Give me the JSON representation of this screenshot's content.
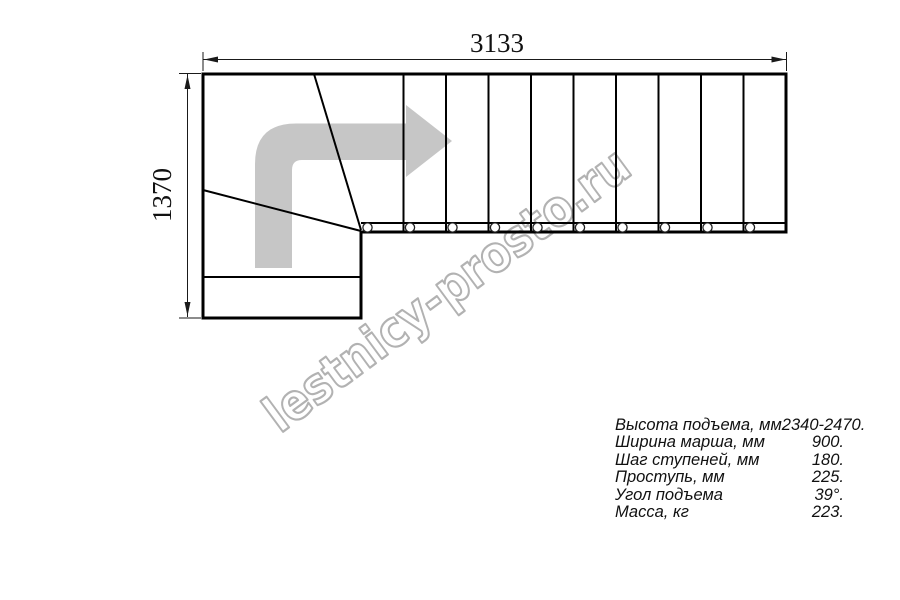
{
  "watermark": {
    "text": "lestnicy-prosto.ru",
    "color": "#b2b2b2"
  },
  "drawing": {
    "width_label": "3133",
    "height_label": "1370",
    "arrow_color": "#c6c6c6",
    "line_color": "#000000",
    "straight_tread_count": 10,
    "baluster_count": 10,
    "winder_count": 2
  },
  "specs": {
    "rows": [
      {
        "label": "Высота подъема, мм",
        "value": "2340-2470."
      },
      {
        "label": "Ширина марша, мм",
        "value": "900."
      },
      {
        "label": "Шаг ступеней, мм",
        "value": "180."
      },
      {
        "label": "Проступь, мм",
        "value": "225."
      },
      {
        "label": "Угол подъема",
        "value": "39°."
      },
      {
        "label": "Масса, кг",
        "value": "223."
      }
    ]
  }
}
